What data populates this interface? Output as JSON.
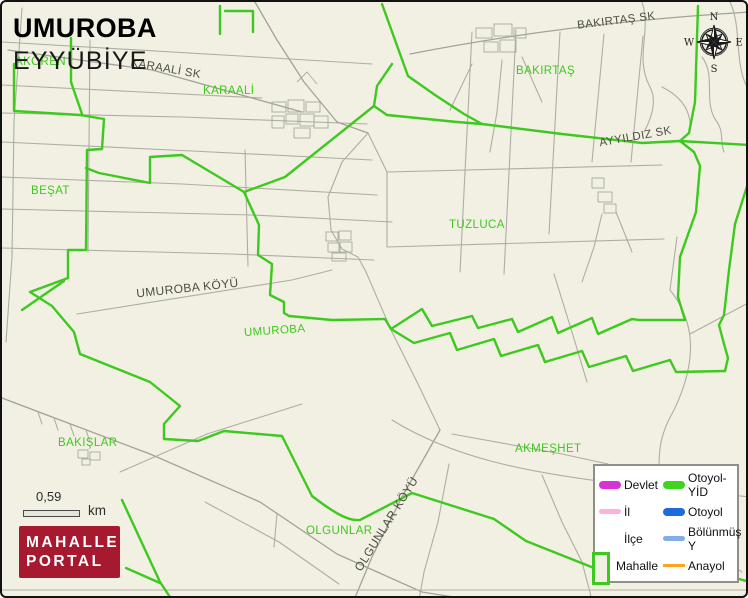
{
  "header": {
    "title": "UMUROBA",
    "subtitle": "EYYÜBİYE"
  },
  "map": {
    "labels": [
      {
        "text": "KARAALİ SK",
        "type": "road"
      },
      {
        "text": "KARAALİ",
        "type": "place"
      },
      {
        "text": "BAKIRTAŞ SK",
        "type": "road"
      },
      {
        "text": "BAKIRTAŞ",
        "type": "place"
      },
      {
        "text": "AYYILDIZ SK",
        "type": "road"
      },
      {
        "text": "BEŞAT",
        "type": "place"
      },
      {
        "text": "TUZLUCA",
        "type": "place"
      },
      {
        "text": "UMUROBA KÖYÜ",
        "type": "road"
      },
      {
        "text": "UMUROBA",
        "type": "place"
      },
      {
        "text": "BAKIŞLAR",
        "type": "place"
      },
      {
        "text": "AKMEŞHET",
        "type": "place"
      },
      {
        "text": "OLGUNLAR",
        "type": "place"
      },
      {
        "text": "OLGUNLAR KÖYÜ",
        "type": "road"
      },
      {
        "text": "AKÖREN",
        "type": "place"
      }
    ],
    "boundary_color": "#3DC91F",
    "road_color": "#ADADA4",
    "background_color": "#F1F0E2"
  },
  "compass": {
    "north": "N",
    "east": "E",
    "south": "S",
    "west": "W"
  },
  "scale_bar": {
    "distance": "0,59",
    "unit": "km"
  },
  "logo": {
    "line1": "MAHALLE",
    "line2": "PORTAL",
    "background": "#A6192E"
  },
  "legend": {
    "admin": [
      {
        "label": "Devlet",
        "color": "#D633D6"
      },
      {
        "label": "İl",
        "color": "#FFB0DC"
      },
      {
        "label": "İlçe",
        "color": "#FFFFFF"
      },
      {
        "label": "Mahalle",
        "color": "#3FC81F"
      }
    ],
    "roads": [
      {
        "label": "Otoyol-YİD",
        "color": "#3FD41F"
      },
      {
        "label": "Otoyol",
        "color": "#1E6BE0"
      },
      {
        "label": "Bölünmüş Y",
        "color": "#7FAEE8"
      },
      {
        "label": "Anayol",
        "color": "#FFA41E"
      }
    ]
  }
}
